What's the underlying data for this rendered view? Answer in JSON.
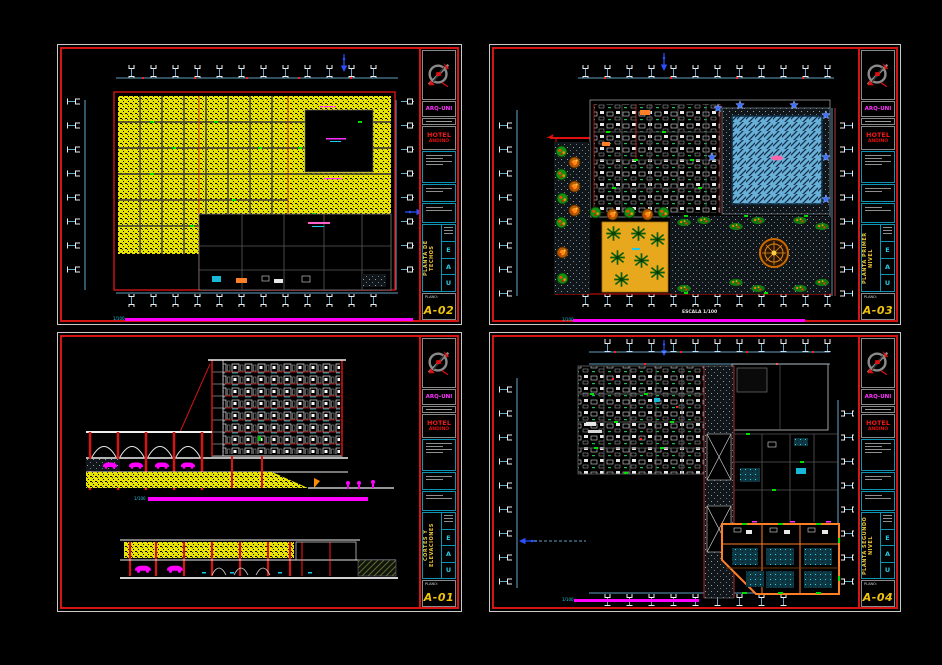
{
  "app": {
    "background": "#000000",
    "description": "CAD model space with four architectural plan sheets"
  },
  "colors": {
    "sheet_border_outer": "#c9c9c9",
    "sheet_border_inner": "#d51414",
    "accent_magenta": "#ff00ff",
    "accent_cyan": "#25c9e4",
    "accent_yellow_hatch": "#f2ee00",
    "accent_blue": "#2b50ff",
    "accent_green": "#149114",
    "accent_orange": "#ff7f27",
    "pool_blue": "#69b0d8",
    "sheet_number_yellow": "#f2c40c",
    "firm_magenta": "#ff35ff",
    "project_red": "#f01818"
  },
  "sheets": [
    {
      "id": "A-02",
      "corner": "top-left",
      "drawing_type": "roof-plan",
      "titleblock": {
        "firm": "ARQ-UNI",
        "project_line1": "HOTEL",
        "project_line2": "ANDINO",
        "vertical_title": "PLANTA DE TECHOS",
        "initials": [
          "E",
          "A",
          "U"
        ],
        "plano_label": "PLANO:",
        "sheet_number": "A-02"
      },
      "caption": {
        "scale_note": "1/100"
      }
    },
    {
      "id": "A-03",
      "corner": "top-right",
      "drawing_type": "site-plan",
      "titleblock": {
        "firm": "ARQ-UNI",
        "project_line1": "HOTEL",
        "project_line2": "ANDINO",
        "vertical_title": "PLANTA PRIMER NIVEL",
        "initials": [
          "E",
          "A",
          "U"
        ],
        "plano_label": "PLANO:",
        "sheet_number": "A-03"
      },
      "caption": {
        "scale_note": "1/100",
        "extra_note": "ESCALA 1/100"
      }
    },
    {
      "id": "A-01",
      "corner": "bottom-left",
      "drawing_type": "sections-elevations",
      "titleblock": {
        "firm": "ARQ-UNI",
        "project_line1": "HOTEL",
        "project_line2": "ANDINO",
        "vertical_title": "CORTES Y ELEVACIONES",
        "initials": [
          "E",
          "A",
          "U"
        ],
        "plano_label": "PLANO:",
        "sheet_number": "A-01"
      },
      "caption": {
        "scale_note": "1/100"
      }
    },
    {
      "id": "A-04",
      "corner": "bottom-right",
      "drawing_type": "floor-plan",
      "titleblock": {
        "firm": "ARQ-UNI",
        "project_line1": "HOTEL",
        "project_line2": "ANDINO",
        "vertical_title": "PLANTA SEGUNDO NIVEL",
        "initials": [
          "E",
          "A",
          "U"
        ],
        "plano_label": "PLANO:",
        "sheet_number": "A-04"
      },
      "caption": {
        "scale_note": "1/100"
      }
    }
  ]
}
